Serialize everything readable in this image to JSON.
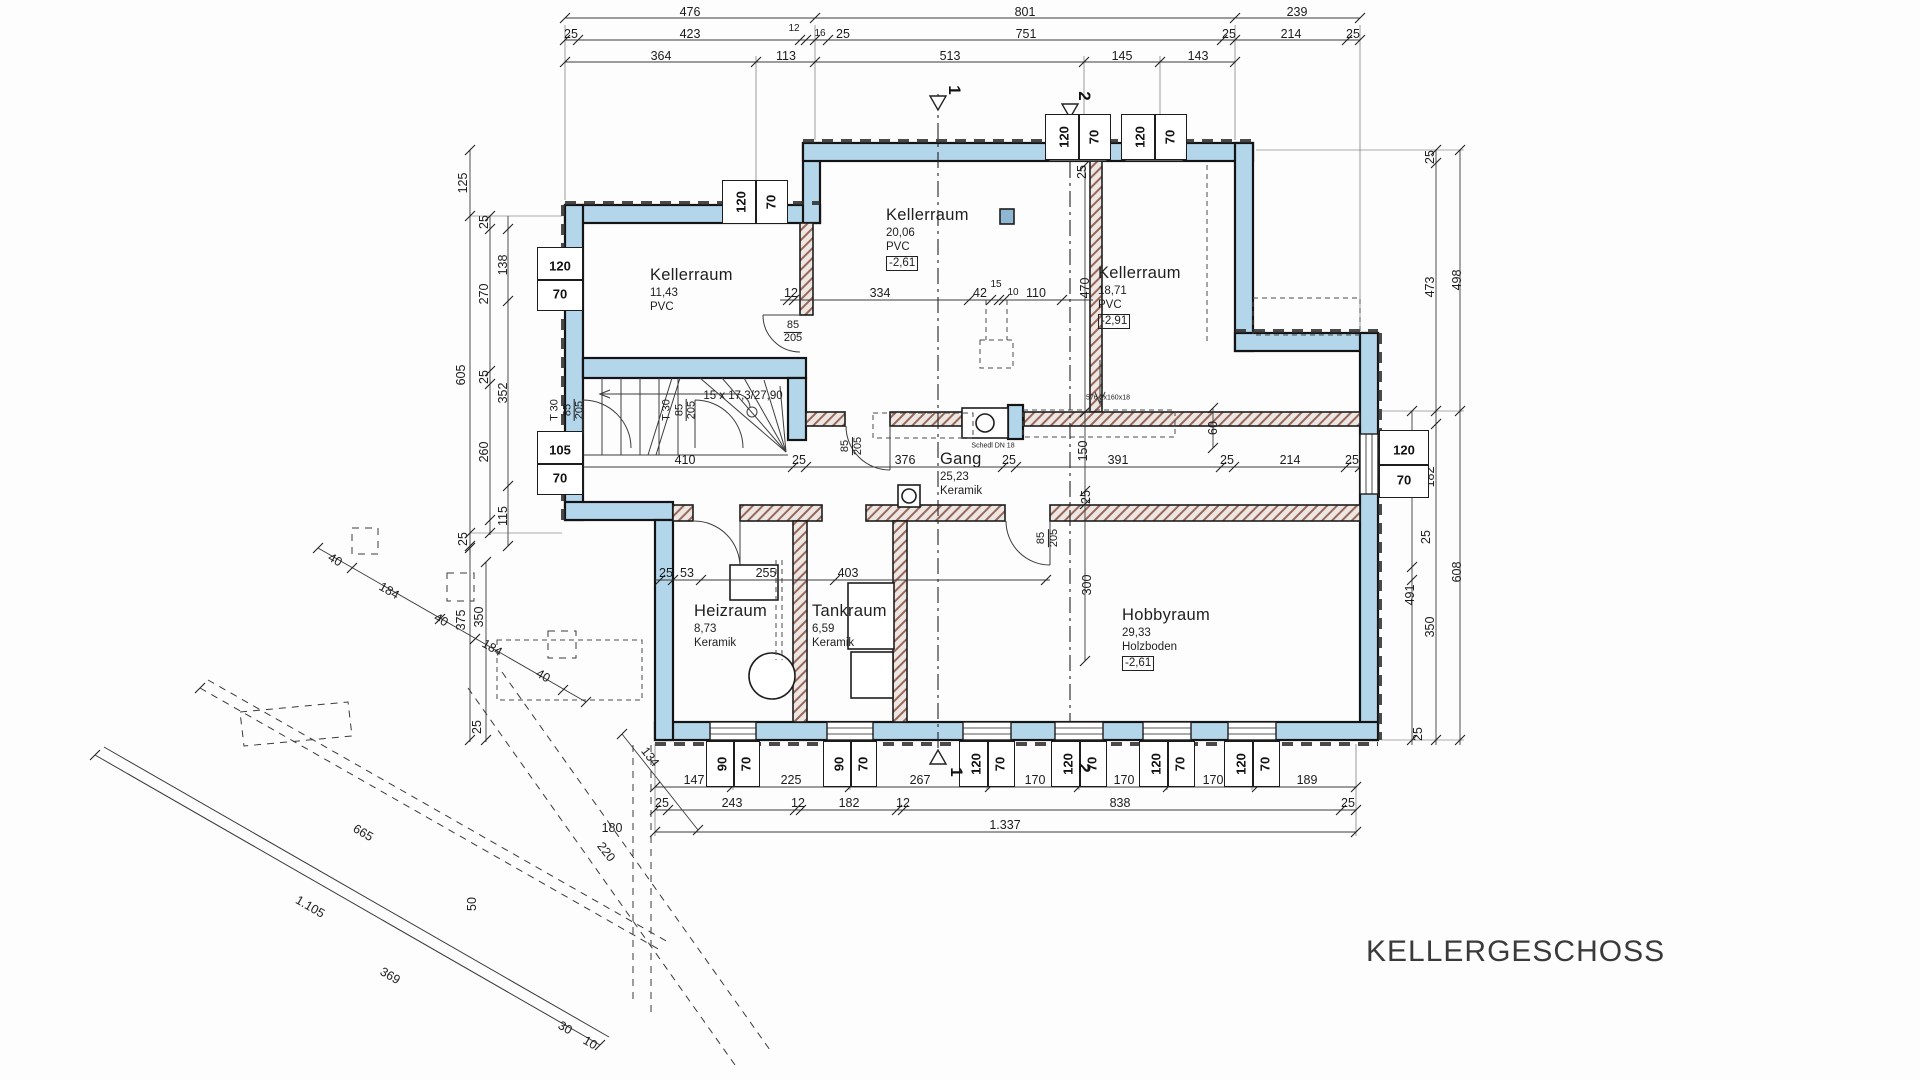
{
  "title": "KELLERGESCHOSS",
  "rooms": [
    {
      "name": "Kellerraum",
      "area": "11,43",
      "floor": "PVC",
      "level": "",
      "x": 650,
      "y": 266
    },
    {
      "name": "Kellerraum",
      "area": "20,06",
      "floor": "PVC",
      "level": "-2,61",
      "x": 886,
      "y": 206
    },
    {
      "name": "Kellerraum",
      "area": "18,71",
      "floor": "PVC",
      "level": "-2,91",
      "x": 1098,
      "y": 264
    },
    {
      "name": "Gang",
      "area": "25,23",
      "floor": "Keramik",
      "level": "",
      "x": 940,
      "y": 450
    },
    {
      "name": "Heizraum",
      "area": "8,73",
      "floor": "Keramik",
      "level": "",
      "x": 694,
      "y": 602
    },
    {
      "name": "Tankraum",
      "area": "6,59",
      "floor": "Keramik",
      "level": "",
      "x": 812,
      "y": 602
    },
    {
      "name": "Hobbyraum",
      "area": "29,33",
      "floor": "Holzboden",
      "level": "-2,61",
      "x": 1122,
      "y": 606
    }
  ],
  "annotations": [
    {
      "t": "15 x 17,3/27,90",
      "x": 743,
      "y": 396,
      "s": 11.5,
      "r": 0
    },
    {
      "t": "Schedl DN 18",
      "x": 993,
      "y": 446,
      "s": 7,
      "r": 0
    },
    {
      "t": "576 2x160x18",
      "x": 1108,
      "y": 398,
      "s": 7,
      "r": 0
    }
  ],
  "doors": [
    {
      "pref": "",
      "num": "85",
      "den": "205",
      "x": 793,
      "y": 332,
      "r": 0
    },
    {
      "pref": "",
      "num": "85",
      "den": "205",
      "x": 852,
      "y": 446,
      "r": -90
    },
    {
      "pref": "",
      "num": "85",
      "den": "205",
      "x": 1048,
      "y": 538,
      "r": -90
    },
    {
      "pref": "T 30",
      "num": "85",
      "den": "205",
      "x": 568,
      "y": 410,
      "r": -90
    },
    {
      "pref": "T 30",
      "num": "85",
      "den": "205",
      "x": 680,
      "y": 410,
      "r": -90
    }
  ],
  "sections": [
    {
      "t": "1",
      "x": 954,
      "y": 90
    },
    {
      "t": "1",
      "x": 956,
      "y": 772
    },
    {
      "t": "2",
      "x": 1084,
      "y": 96
    },
    {
      "t": "2",
      "x": 1084,
      "y": 768
    }
  ],
  "windows": [
    {
      "a": "120",
      "b": "70",
      "x": 722,
      "y": 180,
      "w": 66,
      "h": 44,
      "o": "rot",
      "wall": 205
    },
    {
      "a": "120",
      "b": "70",
      "x": 1045,
      "y": 114,
      "w": 66,
      "h": 46,
      "o": "rot",
      "wall": 143
    },
    {
      "a": "120",
      "b": "70",
      "x": 1121,
      "y": 114,
      "w": 66,
      "h": 46,
      "o": "rot",
      "wall": 143
    },
    {
      "a": "120",
      "b": "70",
      "x": 537,
      "y": 247,
      "w": 46,
      "h": 64,
      "o": "flat",
      "wall": 565
    },
    {
      "a": "105",
      "b": "70",
      "x": 537,
      "y": 431,
      "w": 46,
      "h": 64,
      "o": "flat",
      "wall": 565
    },
    {
      "a": "120",
      "b": "70",
      "x": 1379,
      "y": 430,
      "w": 50,
      "h": 68,
      "o": "flat",
      "wall": 1360
    },
    {
      "a": "90",
      "b": "70",
      "x": 706,
      "y": 741,
      "w": 54,
      "h": 46,
      "o": "rot",
      "wall": 722
    },
    {
      "a": "90",
      "b": "70",
      "x": 823,
      "y": 741,
      "w": 54,
      "h": 46,
      "o": "rot",
      "wall": 722
    },
    {
      "a": "120",
      "b": "70",
      "x": 959,
      "y": 741,
      "w": 56,
      "h": 46,
      "o": "rot",
      "wall": 722
    },
    {
      "a": "120",
      "b": "70",
      "x": 1051,
      "y": 741,
      "w": 56,
      "h": 46,
      "o": "rot",
      "wall": 722
    },
    {
      "a": "120",
      "b": "70",
      "x": 1139,
      "y": 741,
      "w": 56,
      "h": 46,
      "o": "rot",
      "wall": 722
    },
    {
      "a": "120",
      "b": "70",
      "x": 1224,
      "y": 741,
      "w": 56,
      "h": 46,
      "o": "rot",
      "wall": 722
    }
  ],
  "dimensions": [
    {
      "t": "476",
      "x": 690,
      "y": 12
    },
    {
      "t": "801",
      "x": 1025,
      "y": 12
    },
    {
      "t": "239",
      "x": 1297,
      "y": 12
    },
    {
      "t": "25",
      "x": 571,
      "y": 34
    },
    {
      "t": "423",
      "x": 690,
      "y": 34
    },
    {
      "t": "12",
      "x": 794,
      "y": 29,
      "s": 10
    },
    {
      "t": "16",
      "x": 820,
      "y": 34,
      "s": 10
    },
    {
      "t": "25",
      "x": 843,
      "y": 34
    },
    {
      "t": "751",
      "x": 1026,
      "y": 34
    },
    {
      "t": "25",
      "x": 1229,
      "y": 34
    },
    {
      "t": "214",
      "x": 1291,
      "y": 34
    },
    {
      "t": "25",
      "x": 1353,
      "y": 34
    },
    {
      "t": "364",
      "x": 661,
      "y": 56
    },
    {
      "t": "113",
      "x": 786,
      "y": 56
    },
    {
      "t": "513",
      "x": 950,
      "y": 56
    },
    {
      "t": "145",
      "x": 1122,
      "y": 56
    },
    {
      "t": "143",
      "x": 1198,
      "y": 56
    },
    {
      "t": "12",
      "x": 791,
      "y": 293
    },
    {
      "t": "334",
      "x": 880,
      "y": 293
    },
    {
      "t": "42",
      "x": 980,
      "y": 293
    },
    {
      "t": "15",
      "x": 996,
      "y": 285,
      "s": 10
    },
    {
      "t": "10",
      "x": 1013,
      "y": 293,
      "s": 10
    },
    {
      "t": "110",
      "x": 1036,
      "y": 293
    },
    {
      "t": "470",
      "x": 1085,
      "y": 288,
      "r": -90
    },
    {
      "t": "25",
      "x": 1082,
      "y": 172,
      "r": -90
    },
    {
      "t": "25",
      "x": 571,
      "y": 460
    },
    {
      "t": "410",
      "x": 685,
      "y": 460
    },
    {
      "t": "25",
      "x": 799,
      "y": 460
    },
    {
      "t": "376",
      "x": 905,
      "y": 460
    },
    {
      "t": "25",
      "x": 1009,
      "y": 460
    },
    {
      "t": "391",
      "x": 1118,
      "y": 460
    },
    {
      "t": "25",
      "x": 1227,
      "y": 460
    },
    {
      "t": "214",
      "x": 1290,
      "y": 460
    },
    {
      "t": "25",
      "x": 1352,
      "y": 460
    },
    {
      "t": "150",
      "x": 1083,
      "y": 451,
      "r": -90
    },
    {
      "t": "25",
      "x": 1086,
      "y": 497,
      "r": -90
    },
    {
      "t": "300",
      "x": 1087,
      "y": 585,
      "r": -90
    },
    {
      "t": "60",
      "x": 1213,
      "y": 428,
      "r": -90
    },
    {
      "t": "25",
      "x": 666,
      "y": 573
    },
    {
      "t": "53",
      "x": 687,
      "y": 573
    },
    {
      "t": "255",
      "x": 766,
      "y": 573
    },
    {
      "t": "403",
      "x": 848,
      "y": 573
    },
    {
      "t": "147",
      "x": 694,
      "y": 780
    },
    {
      "t": "225",
      "x": 791,
      "y": 780
    },
    {
      "t": "267",
      "x": 920,
      "y": 780
    },
    {
      "t": "170",
      "x": 1035,
      "y": 780
    },
    {
      "t": "170",
      "x": 1124,
      "y": 780
    },
    {
      "t": "170",
      "x": 1213,
      "y": 780
    },
    {
      "t": "189",
      "x": 1307,
      "y": 780
    },
    {
      "t": "25",
      "x": 662,
      "y": 803
    },
    {
      "t": "243",
      "x": 732,
      "y": 803
    },
    {
      "t": "12",
      "x": 798,
      "y": 803
    },
    {
      "t": "182",
      "x": 849,
      "y": 803
    },
    {
      "t": "12",
      "x": 903,
      "y": 803
    },
    {
      "t": "838",
      "x": 1120,
      "y": 803
    },
    {
      "t": "25",
      "x": 1348,
      "y": 803
    },
    {
      "t": "1.337",
      "x": 1005,
      "y": 825
    },
    {
      "t": "125",
      "x": 463,
      "y": 183,
      "r": -90
    },
    {
      "t": "605",
      "x": 461,
      "y": 375,
      "r": -90
    },
    {
      "t": "25",
      "x": 463,
      "y": 539,
      "r": -90
    },
    {
      "t": "25",
      "x": 484,
      "y": 222,
      "r": -90
    },
    {
      "t": "270",
      "x": 484,
      "y": 294,
      "r": -90
    },
    {
      "t": "25",
      "x": 484,
      "y": 377,
      "r": -90
    },
    {
      "t": "260",
      "x": 484,
      "y": 452,
      "r": -90
    },
    {
      "t": "138",
      "x": 503,
      "y": 265,
      "r": -90
    },
    {
      "t": "352",
      "x": 503,
      "y": 393,
      "r": -90
    },
    {
      "t": "115",
      "x": 503,
      "y": 516,
      "r": -90
    },
    {
      "t": "25",
      "x": 1430,
      "y": 157,
      "r": -90
    },
    {
      "t": "473",
      "x": 1430,
      "y": 287,
      "r": -90
    },
    {
      "t": "498",
      "x": 1457,
      "y": 280,
      "r": -90
    },
    {
      "t": "116",
      "x": 1406,
      "y": 441,
      "r": -90
    },
    {
      "t": "182",
      "x": 1430,
      "y": 477,
      "r": -90
    },
    {
      "t": "25",
      "x": 1426,
      "y": 537,
      "r": -90
    },
    {
      "t": "491",
      "x": 1410,
      "y": 595,
      "r": -90
    },
    {
      "t": "350",
      "x": 1430,
      "y": 627,
      "r": -90
    },
    {
      "t": "608",
      "x": 1457,
      "y": 572,
      "r": -90
    },
    {
      "t": "25",
      "x": 1418,
      "y": 734,
      "r": -90
    },
    {
      "t": "40",
      "x": 335,
      "y": 560,
      "r": 30
    },
    {
      "t": "184",
      "x": 389,
      "y": 591,
      "r": 30
    },
    {
      "t": "40",
      "x": 441,
      "y": 620,
      "r": 30
    },
    {
      "t": "184",
      "x": 492,
      "y": 648,
      "r": 30
    },
    {
      "t": "40",
      "x": 543,
      "y": 676,
      "r": 30
    },
    {
      "t": "375",
      "x": 461,
      "y": 620,
      "r": -90
    },
    {
      "t": "350",
      "x": 479,
      "y": 617,
      "r": -90
    },
    {
      "t": "25",
      "x": 477,
      "y": 727,
      "r": -90
    },
    {
      "t": "134",
      "x": 650,
      "y": 757,
      "r": 52
    },
    {
      "t": "180",
      "x": 612,
      "y": 828
    },
    {
      "t": "220",
      "x": 606,
      "y": 852,
      "r": 52
    },
    {
      "t": "665",
      "x": 363,
      "y": 833,
      "r": 30
    },
    {
      "t": "1.105",
      "x": 310,
      "y": 907,
      "r": 30
    },
    {
      "t": "369",
      "x": 390,
      "y": 976,
      "r": 30
    },
    {
      "t": "30",
      "x": 565,
      "y": 1028,
      "r": 30
    },
    {
      "t": "10",
      "x": 590,
      "y": 1043,
      "r": 30
    },
    {
      "t": "50",
      "x": 472,
      "y": 904,
      "r": -90
    }
  ]
}
